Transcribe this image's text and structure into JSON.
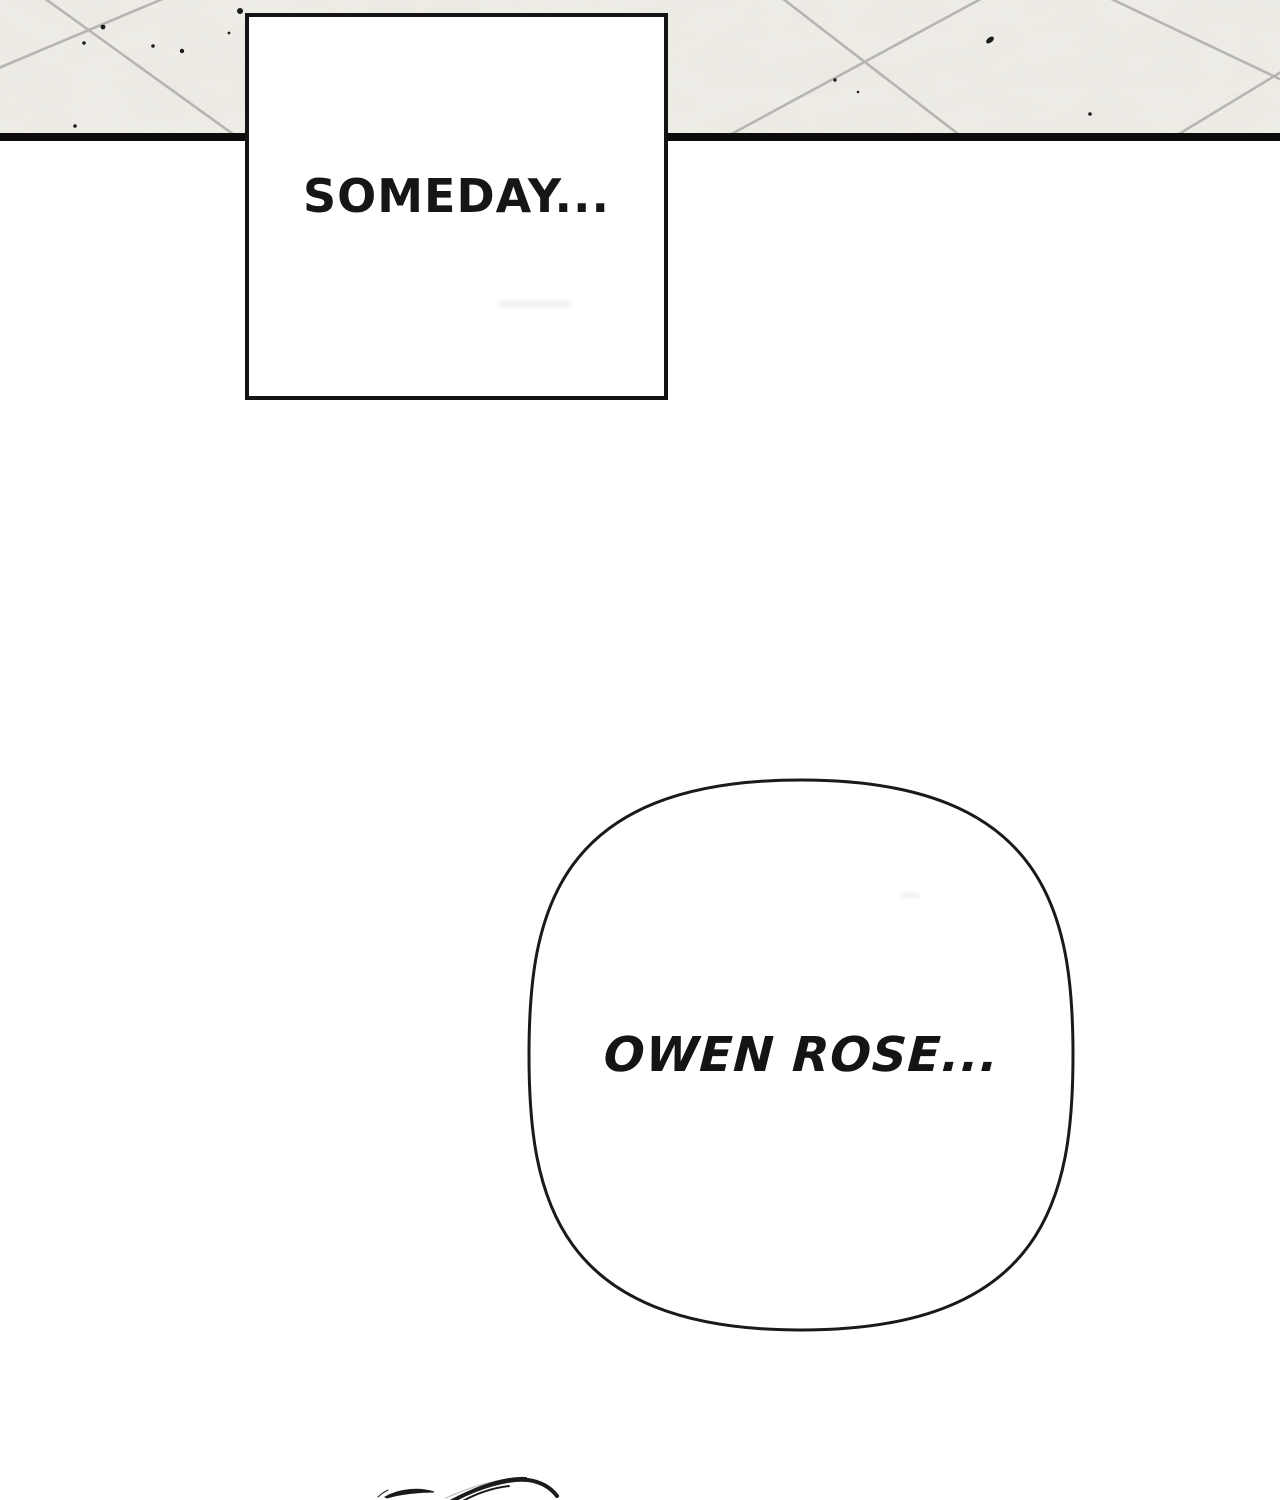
{
  "panel": {
    "caption": "SOMEDAY..."
  },
  "bubble": {
    "text": "OWEN ROSE..."
  },
  "artwork": {
    "floor": "tiled floor seen in perspective with diagonal grout lines and small ink specks",
    "floor_edge": "thick black horizontal line at bottom of floor",
    "caption_box": "rectangular black-bordered caption panel overlapping the floor",
    "speech_bubble": "large rounded-square white speech bubble",
    "hair": "sweeping hair-strand line art entering from bottom edge"
  },
  "colors": {
    "background": "#ffffff",
    "floor": "#f1efe9",
    "grout": "#b2b0ac",
    "ink": "#141414",
    "edge_line": "#0c0c0c"
  }
}
